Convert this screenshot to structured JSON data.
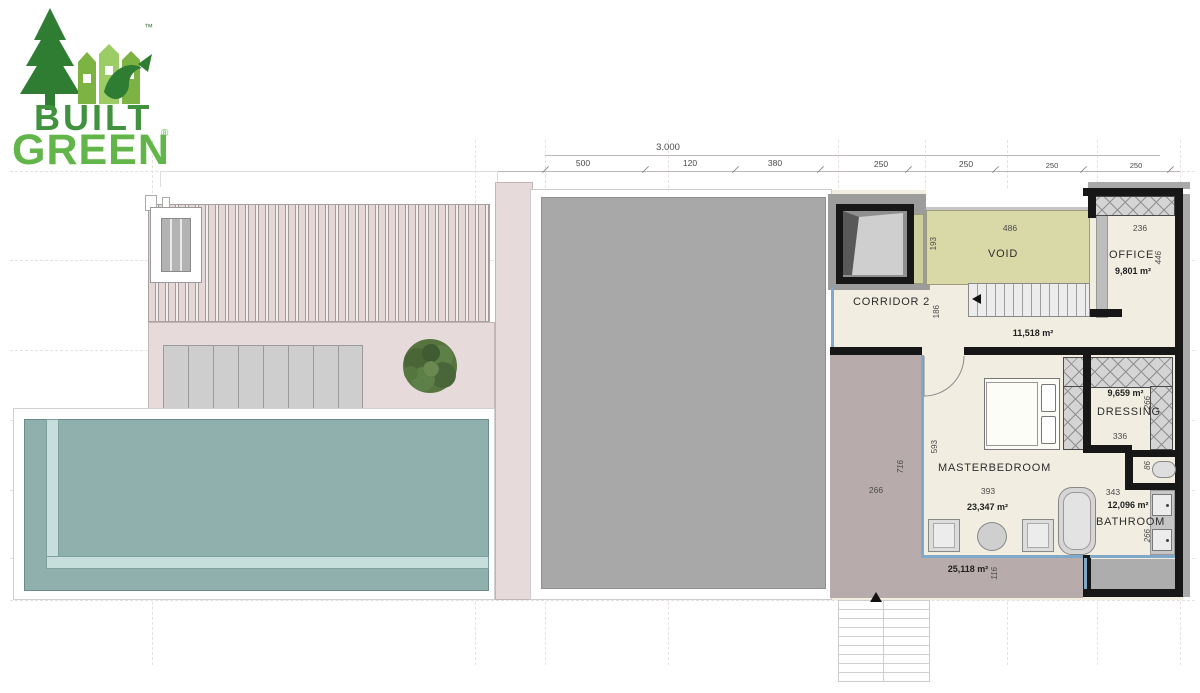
{
  "logo": {
    "built": "BUILT",
    "green": "GREEN",
    "reg": "®",
    "tm": "™"
  },
  "dimensions": {
    "overall": "3.000",
    "top_segments": [
      "500",
      "120",
      "380",
      "250",
      "250",
      "250",
      "250"
    ]
  },
  "rooms": {
    "void": {
      "name": "VOID",
      "dim_width": "486",
      "dim_height": "193"
    },
    "office": {
      "name": "OFFICE",
      "area": "9,801 m²",
      "dim_width": "236",
      "dim_height": "446"
    },
    "corridor2": {
      "name": "CORRIDOR 2",
      "dim_height": "186"
    },
    "stair_hall": {
      "area": "11,518 m²"
    },
    "masterbedroom": {
      "name": "MASTERBEDROOM",
      "area": "23,347 m²",
      "dim_width": "393",
      "dim_height": "593"
    },
    "dressing": {
      "name": "DRESSING",
      "area": "9,659 m²",
      "dim_width": "336",
      "dim_height": "266"
    },
    "wc": {
      "dim_height": "86"
    },
    "bathroom": {
      "name": "BATHROOM",
      "area": "12,096 m²",
      "dim_width": "343",
      "dim_height": "266"
    },
    "terrace": {
      "area": "25,118 m²",
      "dim_width": "266",
      "dim_height": "716",
      "dim_edge": "116"
    }
  },
  "colors": {
    "logo_dark_green": "#2f7d33",
    "logo_light_green": "#62b548",
    "pool_water": "#8fb0ac",
    "pool_ledge": "#c6dfdc",
    "void_fill": "#d9d9a8",
    "roof_gray": "#a8a8a8",
    "roof_pink": "#e7dada",
    "terrace_mauve": "#b7acab",
    "floor_cream": "#f1eee1",
    "wall_black": "#171717",
    "glass_blue": "#7fa8c9"
  }
}
